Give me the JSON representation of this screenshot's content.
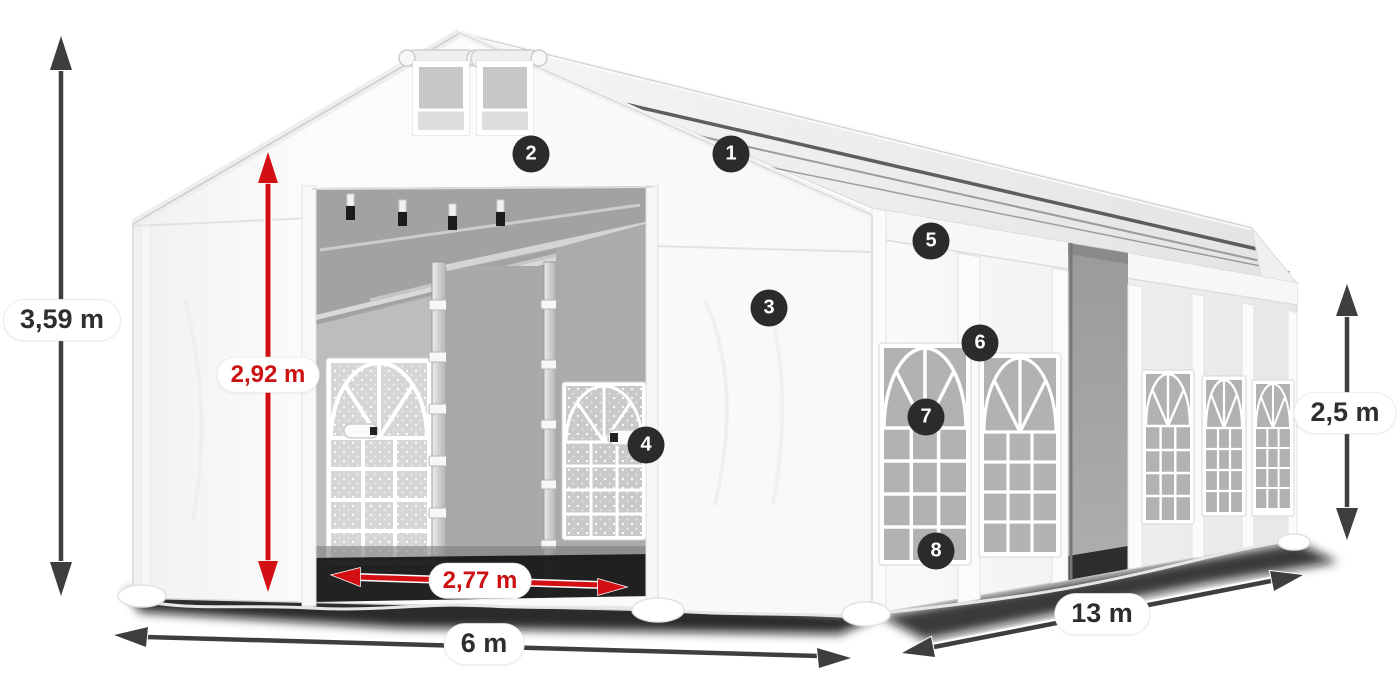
{
  "diagram": {
    "type": "product-dimension-diagram",
    "subject": "white marquee storage tent with numbered feature callouts"
  },
  "dimensions": {
    "total_height": "3,59 m",
    "entrance_height": "2,92 m",
    "entrance_width": "2,77 m",
    "gable_width": "6 m",
    "length": "13 m",
    "side_wall_height": "2,5 m"
  },
  "callouts": [
    {
      "number": "1"
    },
    {
      "number": "2"
    },
    {
      "number": "3"
    },
    {
      "number": "4"
    },
    {
      "number": "5"
    },
    {
      "number": "6"
    },
    {
      "number": "7"
    },
    {
      "number": "8"
    }
  ],
  "colors": {
    "dimension_arrow_dark": "#3e3e3e",
    "dimension_arrow_red": "#d21014",
    "dimension_text_dark": "#2e2e2e",
    "dimension_text_red": "#cc1113",
    "callout_background": "#2b2b2b",
    "callout_text": "#ffffff",
    "canvas_background": "#ffffff"
  }
}
